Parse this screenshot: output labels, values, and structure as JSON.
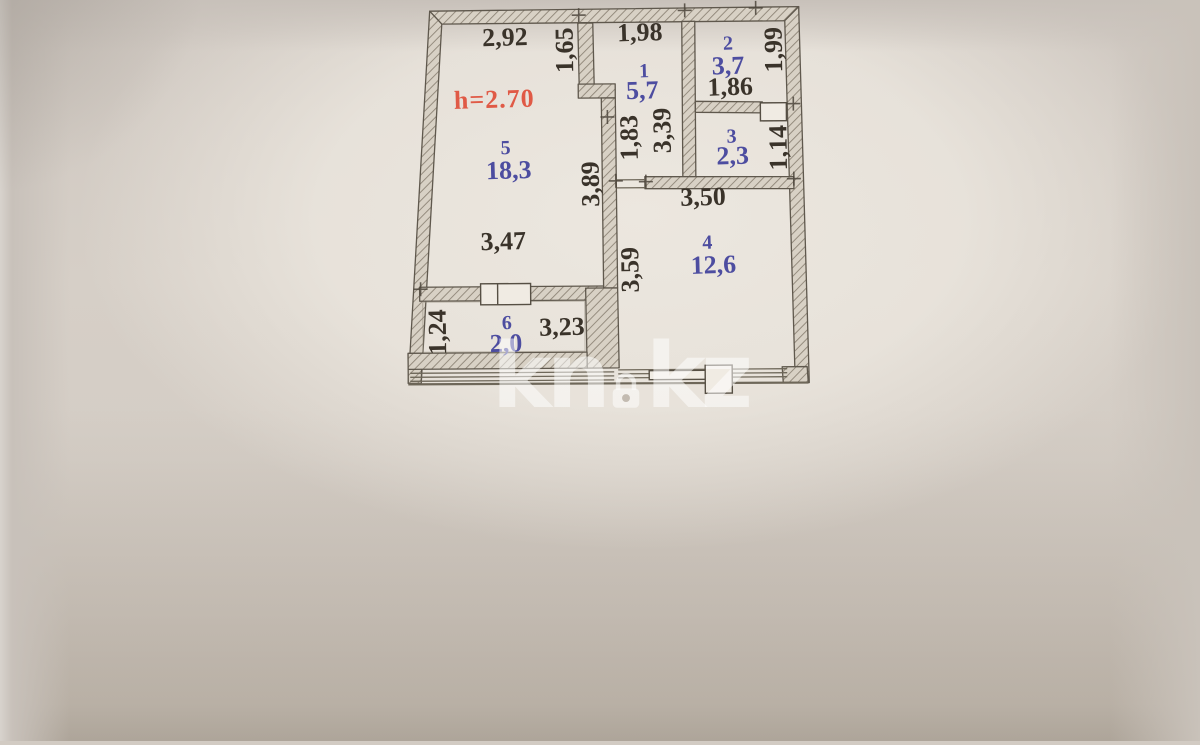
{
  "watermark": {
    "part1": "kn",
    "part2": "kz",
    "icon": "lock-icon"
  },
  "plan": {
    "ceiling_height": "h=2.70",
    "rooms": [
      {
        "number": "1",
        "area": "5,7"
      },
      {
        "number": "2",
        "area": "3,7"
      },
      {
        "number": "3",
        "area": "2,3"
      },
      {
        "number": "4",
        "area": "12,6"
      },
      {
        "number": "5",
        "area": "18,3"
      },
      {
        "number": "6",
        "area": "2,0"
      }
    ],
    "dimensions": {
      "room5_top_width": "2,92",
      "corridor_notch_depth": "1,65",
      "corridor_top_width": "1,98",
      "room2_width": "1,86",
      "room2_depth": "1,99",
      "corridor_lower_width": "1,83",
      "corridor_length": "3,39",
      "room3_depth": "1,14",
      "room5_length": "3,89",
      "room4_top_width": "3,50",
      "room5_bottom_width": "3,47",
      "room4_length": "3,59",
      "balcony_depth": "1,24",
      "balcony_width": "3,23"
    }
  },
  "colors": {
    "dimension_text": "#3a332a",
    "room_label": "#4d4da0",
    "height_text": "#e05a46",
    "watermark": "rgba(255,255,255,0.52)"
  }
}
